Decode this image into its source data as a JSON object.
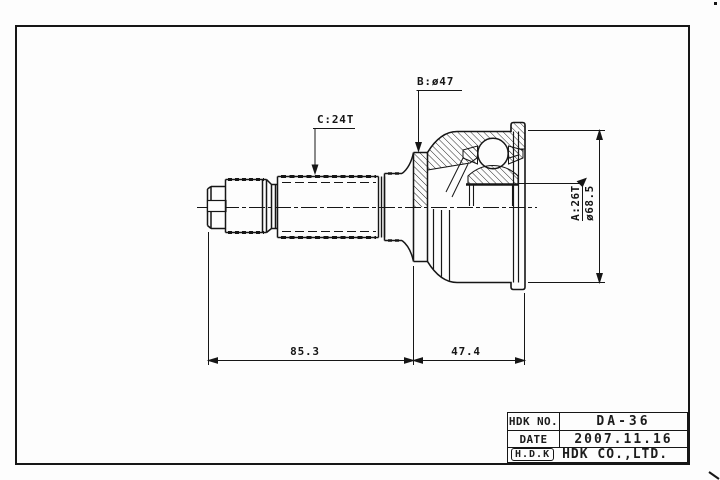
{
  "colors": {
    "ink": "#161616",
    "paper": "#fdfdfd"
  },
  "callouts": {
    "spline_c": "C:24T",
    "diameter_b": "B:ø47",
    "spline_a": "A:26T",
    "outer_diameter": "ø68.5"
  },
  "dimensions": {
    "shaft_length": "85.3",
    "joint_length": "47.4"
  },
  "title_block": {
    "rows": [
      {
        "label": "HDK NO.",
        "value": "DA-36"
      },
      {
        "label": "DATE",
        "value": "2007.11.16"
      }
    ],
    "logo": "H.D.K",
    "company": "HDK CO.,LTD."
  }
}
